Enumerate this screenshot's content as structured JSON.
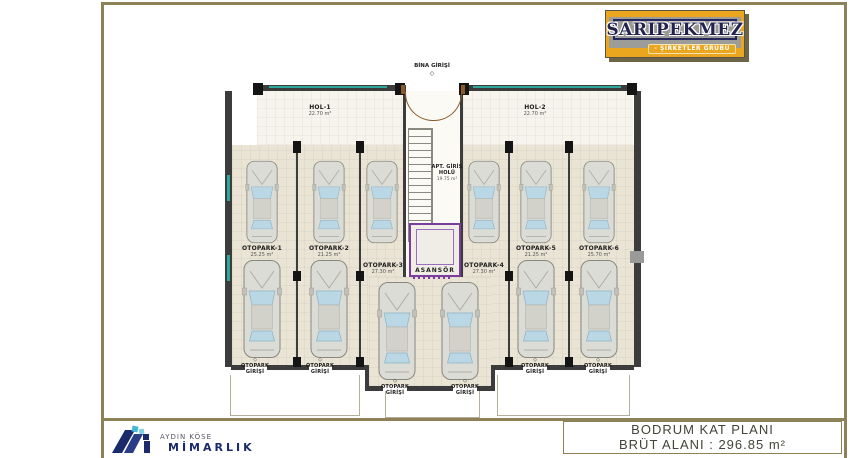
{
  "brand": {
    "name": "SARIPEKMEZ",
    "tagline": "- ŞİRKETLER GRUBU"
  },
  "footer": {
    "firm_name": "AYDIN KÖSE",
    "firm_title": "MİMARLIK",
    "plan_title": "BODRUM KAT PLANI",
    "area_line": "BRÜT ALANI : 296.85 m²"
  },
  "plan": {
    "entrance_label": "BİNA GİRİŞİ",
    "marker": "◇",
    "halls": [
      {
        "name": "HOL-1",
        "area": "22.70 m²"
      },
      {
        "name": "HOL-2",
        "area": "22.70 m²"
      }
    ],
    "apt_hall": {
      "line1": "APT. GİRİŞ",
      "line2": "HOLÜ",
      "area": "19.75 m²"
    },
    "elevator_label": "ASANSÖR",
    "spots": [
      {
        "name": "OTOPARK-1",
        "area": "25.25 m²"
      },
      {
        "name": "OTOPARK-2",
        "area": "21.25 m²"
      },
      {
        "name": "OTOPARK-3",
        "area": "27.30 m²"
      },
      {
        "name": "OTOPARK-4",
        "area": "27.30 m²"
      },
      {
        "name": "OTOPARK-5",
        "area": "21.25 m²"
      },
      {
        "name": "OTOPARK-6",
        "area": "25.70 m²"
      }
    ],
    "entry": {
      "line1": "OTOPARK",
      "line2": "GİRİŞİ"
    }
  },
  "colors": {
    "frame_olive": "#8d8157",
    "brand_gold": "#eaa61f",
    "wall_dark": "#3c3c3c",
    "floor_beige": "#e9e4d4",
    "accent_teal": "#2fa79b",
    "accent_purple": "#7a3d9e",
    "firm_navy": "#1b2a6b"
  }
}
